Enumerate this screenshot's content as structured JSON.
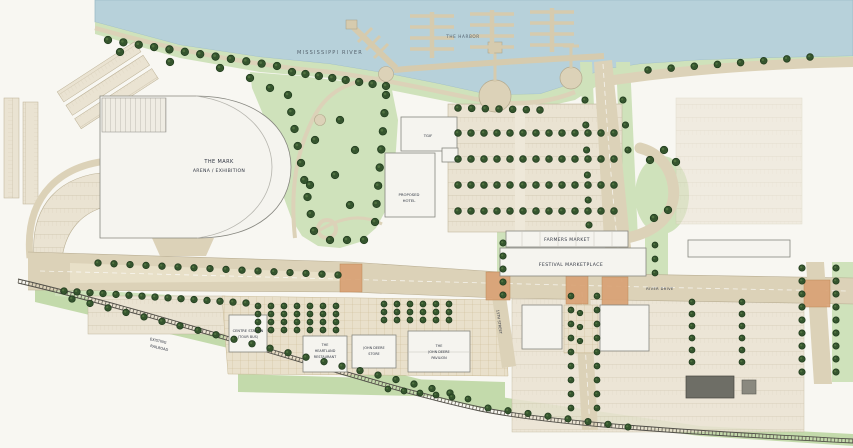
{
  "labels": {
    "river": "MISSISSIPPI RIVER",
    "harbor": "THE HARBOR",
    "arena": {
      "line1": "THE MARK",
      "line2": "ARENA / EXHIBITION"
    },
    "tgif": "TGIF",
    "hotel": {
      "line1": "PROPOSED",
      "line2": "HOTEL"
    },
    "farmers_market": "FARMERS MARKET",
    "festival_marketplace": "FESTIVAL MARKETPLACE",
    "centre_station": {
      "line1": "CENTRE STATION",
      "line2": "(TOUR BUS)"
    },
    "heartland": {
      "line1": "THE",
      "line2": "HEARTLAND",
      "line3": "RESTAURANT"
    },
    "deere_store": {
      "line1": "JOHN DEERE",
      "line2": "STORE"
    },
    "deere_pavilion": {
      "line1": "THE",
      "line2": "JOHN DEERE",
      "line3": "PAVILION"
    },
    "railroad": {
      "line1": "EXISTING",
      "line2": "RAILROAD"
    },
    "river_drive": "RIVER DRIVE",
    "street": "15TH STREET"
  },
  "colors": {
    "water": "#b7d1da",
    "park_green": "#cfe2bb",
    "tree_green": "#35552e",
    "road_tan": "#dcd2b8",
    "paving_orange": "#d9a275",
    "building_white": "#f5f4ef",
    "rail_gray": "#514f48",
    "paper": "#f8f7f2"
  }
}
